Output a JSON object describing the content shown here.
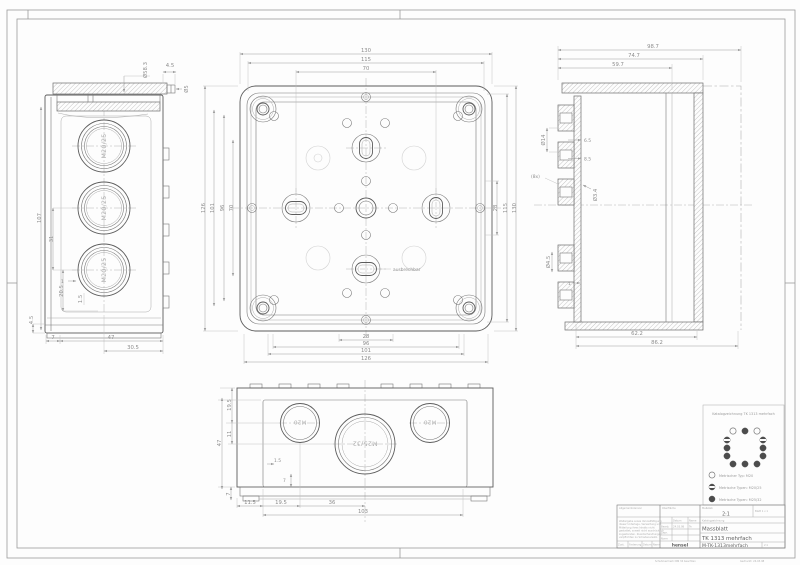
{
  "side": {
    "labels": [
      "M20/25",
      "M20/25",
      "M20/25"
    ],
    "dims": {
      "dia": "Ø58.3",
      "lipw": "4.5",
      "lipd": "Ø5",
      "h": "107",
      "mid": "31",
      "low": "20.5",
      "foot": "4.5",
      "wall": "1",
      "wall2": "1.5",
      "b1": "7",
      "b2": "47",
      "b3": "30.5"
    }
  },
  "plan": {
    "note": "ausbrechbar",
    "top": [
      "130",
      "115",
      "70"
    ],
    "right": [
      "28",
      "115",
      "130"
    ],
    "left": [
      "126",
      "101",
      "96",
      "70"
    ],
    "bottom": [
      "28",
      "96",
      "101",
      "126"
    ]
  },
  "section": {
    "top": [
      "98.7",
      "74.7",
      "59.7"
    ],
    "bottom": [
      "62.2",
      "86.2"
    ],
    "labels": {
      "dia14": "Ø14",
      "g1": "6.5",
      "g2": "8.5",
      "cnt": "(8x)",
      "dia34": "Ø3.4",
      "dia45": "Ø4.5",
      "one": "1"
    }
  },
  "front": {
    "labels": [
      "M20",
      "M25/32",
      "M20"
    ],
    "left": [
      "19.5",
      "11",
      "47"
    ],
    "small": [
      "1.5",
      "7",
      "7"
    ],
    "bottom": [
      "11.5",
      "19.5",
      "36",
      "103"
    ]
  },
  "legend": {
    "title": "Katalogzeichnung TK 1313 mehrfach",
    "items": [
      {
        "type": "open",
        "label": "Metrischer Typ: M20"
      },
      {
        "type": "half",
        "label": "Metrische Typen: M20/25"
      },
      {
        "type": "filled",
        "label": "Metrische Typen: M25/32"
      }
    ]
  },
  "tb": {
    "tol": "Allgemeintoleranz",
    "surf": "Oberfläche",
    "scale_label": "Maßstab",
    "scale": "2:1",
    "sheet": "Blatt 1 v 1",
    "kind": "Katalogzeichnung",
    "doc": "Massblatt",
    "title": "TK 1313 mehrfach",
    "number": "M-TK-1313mehrfach",
    "logo": "hensel",
    "h_datum": "Datum",
    "h_name": "Name",
    "r1": "Bearb.",
    "r1d": "24.03.98",
    "r1n": "Te",
    "r2": "Gepr.",
    "r3": "Norm",
    "note": [
      "Weitergabe sowie Vervielfältigung",
      "dieser Unterlage, Verwertung und",
      "Mitteilung ihres Inhalts nicht",
      "gestattet, soweit nicht ausdrücklich",
      "zugestanden. Zuwiderhandlungen",
      "verpflichten zu Schadenersatz."
    ],
    "bc1": "Zust.",
    "bc2": "Änderung",
    "bc3": "Datum",
    "bc4": "Name",
    "f1": "Schutzvermerk DIN 34 beachten",
    "f2": "Gedruckt: 24.03.98"
  }
}
